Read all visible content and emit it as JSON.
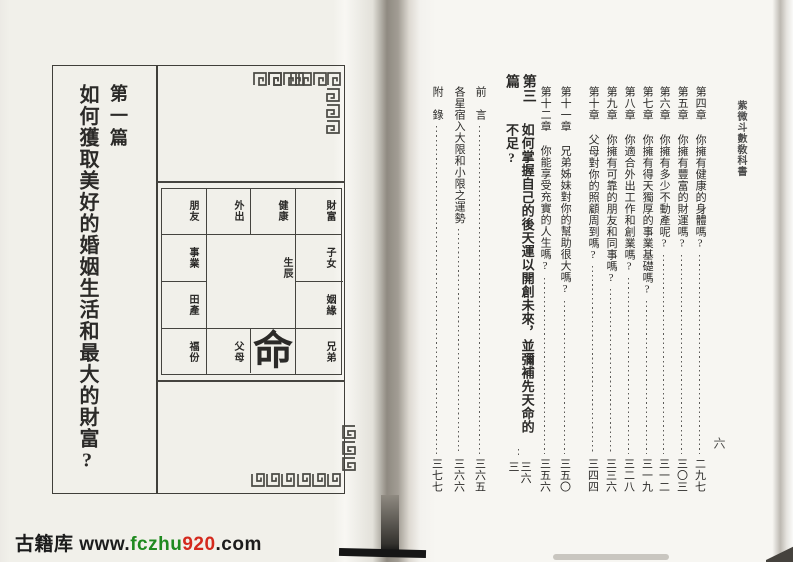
{
  "book": {
    "running_header": "紫微斗數敎科書",
    "folio": "六"
  },
  "left_page": {
    "part_label": "第一篇",
    "part_title": "如何獲取美好的婚姻生活和最大的財富?",
    "chart": {
      "center_char": "命",
      "center_label": "生辰",
      "cells": {
        "r1c1": "朋友",
        "r1c2": "外出",
        "r1c3": "健康",
        "r1c4": "財富",
        "r2c1": "事業",
        "r2c4": "子女",
        "r3c1": "田產",
        "r3c4": "姻緣",
        "r4c1": "福份",
        "r4c2": "父母",
        "r4c4": "兄弟"
      }
    }
  },
  "toc": {
    "items": [
      {
        "label": "第四章",
        "title": "你擁有健康的身體嗎?",
        "page": "二九七"
      },
      {
        "label": "第五章",
        "title": "你擁有豐富的財運嗎?",
        "page": "三〇三"
      },
      {
        "label": "第六章",
        "title": "你擁有多少不動產呢?",
        "page": "三一二"
      },
      {
        "label": "第七章",
        "title": "你擁有得天獨厚的事業基礎嗎?",
        "page": "三一九"
      },
      {
        "label": "第八章",
        "title": "你適合外出工作和創業嗎?",
        "page": "三二八"
      },
      {
        "label": "第九章",
        "title": "你擁有可靠的朋友和同事嗎?",
        "page": "三三六"
      },
      {
        "label": "第十章",
        "title": "父母對你的照顧周到嗎?",
        "page": "三四四"
      },
      {
        "label": "第十一章",
        "title": "兄弟姊妹對你的幫助很大嗎?",
        "page": "三五〇"
      },
      {
        "label": "第十二章",
        "title": "你能享受充實的人生嗎?",
        "page": "三五六"
      },
      {
        "label": "第三篇",
        "title": "如何掌握自己的後天運以開創未來，並彌補先天命的不足?",
        "page": "三六三"
      },
      {
        "label": "",
        "title": "前　言",
        "page": "三六五"
      },
      {
        "label": "",
        "title": "各星宿入大限和小限之運勢",
        "page": "三六六"
      },
      {
        "label": "",
        "title": "附　錄",
        "page": "三七七"
      }
    ]
  },
  "watermark": {
    "site_name": "古籍库",
    "url_prefix": " www.",
    "url_green": "fczhu",
    "url_red": "920",
    "url_suffix": ".com"
  },
  "colors": {
    "accent_green": "#1f8a1f",
    "accent_red": "#d4291d",
    "ink": "#2b2a28",
    "paper_left": "#f1f0ea",
    "paper_right": "#f7f6f2"
  }
}
